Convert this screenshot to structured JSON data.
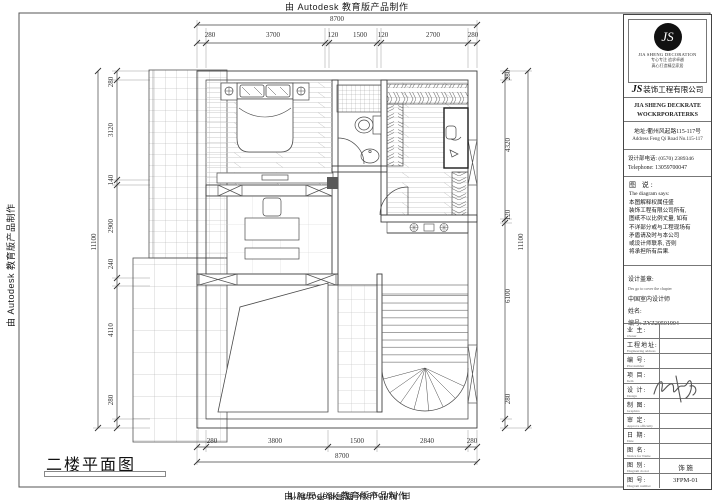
{
  "watermark": {
    "text": "由 Autodesk 教育版产品制作"
  },
  "plan": {
    "label": "二楼平面图",
    "dims": {
      "top": {
        "overall": "8700",
        "segments": [
          "280",
          "3700",
          "120",
          "1500",
          "120",
          "2700",
          "280"
        ]
      },
      "bottom": {
        "overall": "8700",
        "segments": [
          "280",
          "3800",
          "1500",
          "2840",
          "280"
        ]
      },
      "left": {
        "overall": "11100",
        "segments": [
          "280",
          "3120",
          "140",
          "2900",
          "240",
          "4110",
          "280"
        ]
      },
      "right": {
        "overall": "11100",
        "segments": [
          "280",
          "4320",
          "120",
          "6100",
          "280"
        ]
      }
    }
  },
  "title_block": {
    "logo": {
      "monogram": "JS",
      "brand": "JIA SHENG DECORATION",
      "tagline1": "专心专注 追求卓越",
      "tagline2": "真心打造精品家居"
    },
    "company_js": "JS",
    "company_cn": "装饰工程有限公司",
    "company_en1": "JIA SHENG DECKRATE",
    "company_en2": "WOCKRPORATERKS",
    "address_cn": "地址:衢州风起路115-117号",
    "address_en": "Address Feng Qi Road No.115-117",
    "phone_cn": "设计部电话:  (0570) 2389346",
    "phone_en": "Telephone:  13059700047",
    "note_title_cn": "图 说:",
    "note_title_en": "The diagram says:",
    "note_lines": [
      "本图解释权属佳盛",
      "装饰工程有限公司所有,",
      "图纸不以比例丈量, 如有",
      "不详部分或与工程现场有",
      "矛盾请及时与本公司",
      "或设计师联系, 否则",
      "将承担所有后果."
    ],
    "seal": {
      "label": "设计盖章:",
      "sublabel": "Des go to cover the chapter",
      "line1": "中国室内设计师",
      "line2": "姓名:",
      "line3": "编号: ZYZ20501904"
    },
    "rows": [
      {
        "label": "业 主:",
        "sub": "Owner",
        "value": ""
      },
      {
        "label": "工程地址:",
        "sub": "Engineering address",
        "value": ""
      },
      {
        "label": "编 号:",
        "sub": "Plot number",
        "value": ""
      },
      {
        "label": "项 目:",
        "sub": "Item",
        "value": ""
      },
      {
        "label": "设 计:",
        "sub": "Design",
        "value": ""
      },
      {
        "label": "制 图:",
        "sub": "Graphics",
        "value": ""
      },
      {
        "label": "审 定:",
        "sub": "Approve officially",
        "value": ""
      },
      {
        "label": "日 期:",
        "sub": "Date",
        "value": ""
      },
      {
        "label": "图 名:",
        "sub": "Notice for Name",
        "value": ""
      },
      {
        "label": "图 别:",
        "sub": "Diagram do not",
        "value": "饰 施"
      },
      {
        "label": "图 号:",
        "sub": "Diagram number",
        "value": "3FPM-01"
      }
    ]
  }
}
